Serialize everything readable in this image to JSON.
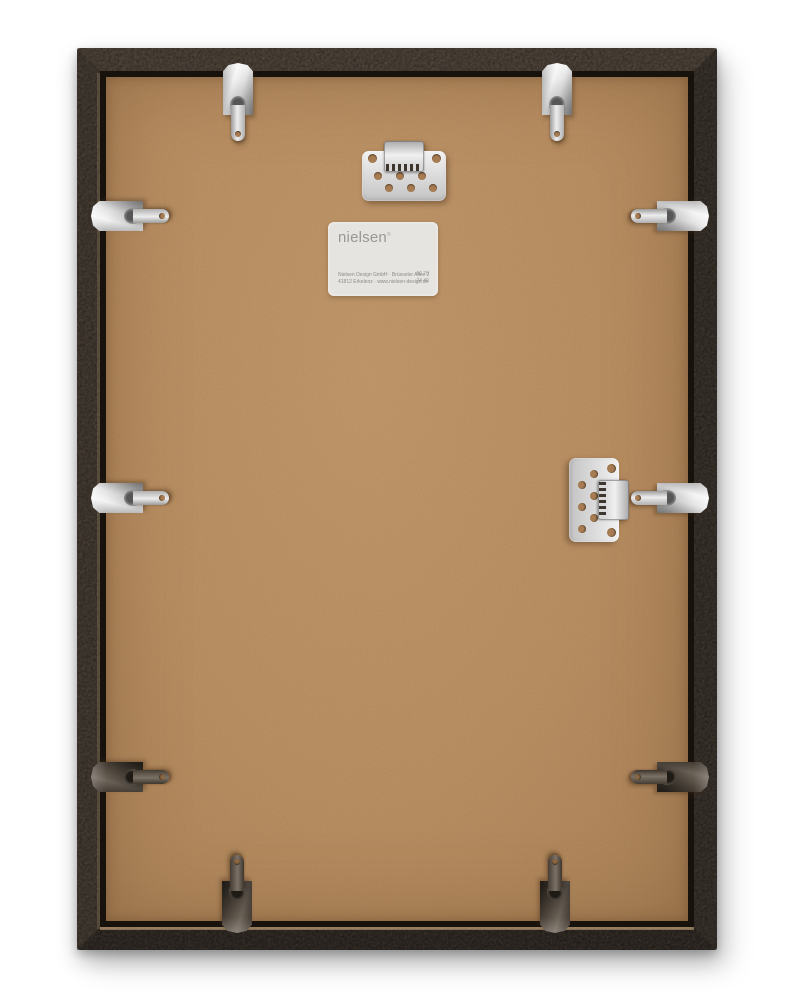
{
  "scene": {
    "subject": "back-of-picture-frame",
    "brand": "nielsen"
  },
  "colors": {
    "board": "#bd9166",
    "frame_dark": "#382f29",
    "frame_light": "#5d5043",
    "channel": "#18120d",
    "silver": "#e8e8e8",
    "dark_metal": "#4a4138",
    "label_bg": "#e6e4e0"
  },
  "label": {
    "logo": "nielsen",
    "trademark": "®",
    "address_line1": "Nielsen Design GmbH · Brüsseler Allee 2",
    "address_line2": "41812 Erkelenz · www.nielsen-design.de",
    "code_line1": "50 70",
    "code_line2": "24 40"
  },
  "hardware": {
    "clips": [
      {
        "name": "spring-clip-top-left",
        "x": 238,
        "y": 103,
        "orientation": "down",
        "finish": "silver"
      },
      {
        "name": "spring-clip-top-right",
        "x": 557,
        "y": 103,
        "orientation": "down",
        "finish": "silver"
      },
      {
        "name": "spring-clip-left-upper",
        "x": 131,
        "y": 216,
        "orientation": "right",
        "finish": "silver"
      },
      {
        "name": "spring-clip-left-middle",
        "x": 131,
        "y": 498,
        "orientation": "right",
        "finish": "silver"
      },
      {
        "name": "spring-clip-left-lower",
        "x": 131,
        "y": 777,
        "orientation": "right",
        "finish": "dark"
      },
      {
        "name": "spring-clip-right-upper",
        "x": 669,
        "y": 216,
        "orientation": "left",
        "finish": "silver"
      },
      {
        "name": "spring-clip-right-middle",
        "x": 669,
        "y": 498,
        "orientation": "left",
        "finish": "silver"
      },
      {
        "name": "spring-clip-right-lower",
        "x": 669,
        "y": 777,
        "orientation": "left",
        "finish": "dark"
      },
      {
        "name": "spring-clip-bottom-left",
        "x": 237,
        "y": 893,
        "orientation": "up",
        "finish": "dark"
      },
      {
        "name": "spring-clip-bottom-right",
        "x": 555,
        "y": 893,
        "orientation": "up",
        "finish": "dark"
      }
    ],
    "plates": [
      {
        "name": "hanger-plate-top",
        "x": 404,
        "y": 171,
        "orientation": "horizontal"
      },
      {
        "name": "hanger-plate-right",
        "x": 599,
        "y": 500,
        "orientation": "vertical"
      }
    ]
  }
}
